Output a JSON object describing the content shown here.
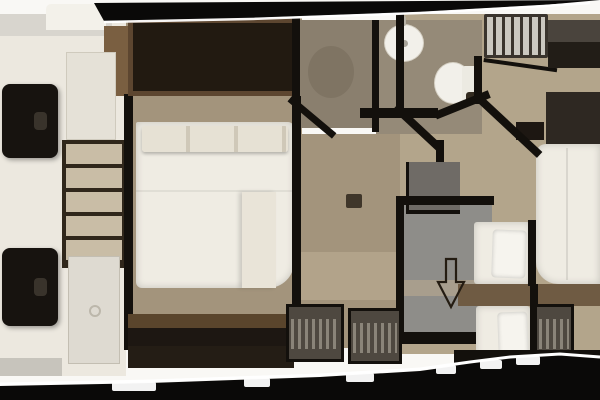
{
  "document": {
    "kind": "yacht-lower-deck-floor-plan",
    "visible_text": "",
    "symbols": {
      "companionway_arrow": "outlined arrow pointing down (aft) in corridor"
    },
    "regions": [
      "tender-garage-port",
      "master-cabin-amidships",
      "shower-room",
      "bathroom",
      "companionway-stairs",
      "starboard-guest-cabin",
      "aft-twin-berths",
      "corridor-landing",
      "hanging-wardrobes"
    ],
    "fixtures": [
      "sink-oval",
      "toilet",
      "shower-tray",
      "double-bed-master",
      "double-bed-starboard",
      "single-berth-upper",
      "single-berth-lower",
      "chest-of-drawers",
      "black-lounge-seat-forward",
      "black-lounge-seat-aft"
    ]
  },
  "palette": {
    "outer": "#f9f8f5",
    "hull": "#0a0908",
    "hull_highlight": "#ffffff",
    "wall": "#13100c",
    "garage_floor": "#ece8df",
    "gray_panel": "#d8d5ce",
    "light_panel": "#e5e1d7",
    "door_panel": "#dedad1",
    "step_gray": "#c7c4bc",
    "dark_furniture": "#17130f",
    "seat_highlight": "#39332b",
    "drawer_front": "#c9bda6",
    "drawer_frame": "#30271b",
    "wood_trim": "#7a5f41",
    "wardrobe_frame": "#5d4630",
    "wardrobe_dark": "#221a11",
    "cabin_floor": "#a3947c",
    "bed_linen": "#efece3",
    "pillow_white": "#f6f4ee",
    "pillow_shade": "#e6e1d4",
    "blanket": "#e9e4d8",
    "bench_wood": "#5a452c",
    "bench_front": "#1d1712",
    "lockers": "#241d15",
    "shower_floor": "#8a7f6e",
    "shower_tray": "#7d7262",
    "bath_floor": "#958a78",
    "fixture_white": "#f2f0ea",
    "fixture_line": "#d6d1c5",
    "stair_tread": "#cbc8c0",
    "stair_dark": "#3a342d",
    "cabinet_gray": "#4a443d",
    "cabinet_front": "#221d17",
    "headboard": "#2e2822",
    "starboard_floor": "#b3a58b",
    "desk_gray": "#6f6b66",
    "corridor_floor": "#8e8d89",
    "corridor_band": "#a89e8d",
    "mid_band": "#b5a68d",
    "wood_band": "#6f5b43",
    "closet_body": "#4e4840",
    "closet_stripe": "#8a8479",
    "arrow_outline": "#241c12"
  }
}
